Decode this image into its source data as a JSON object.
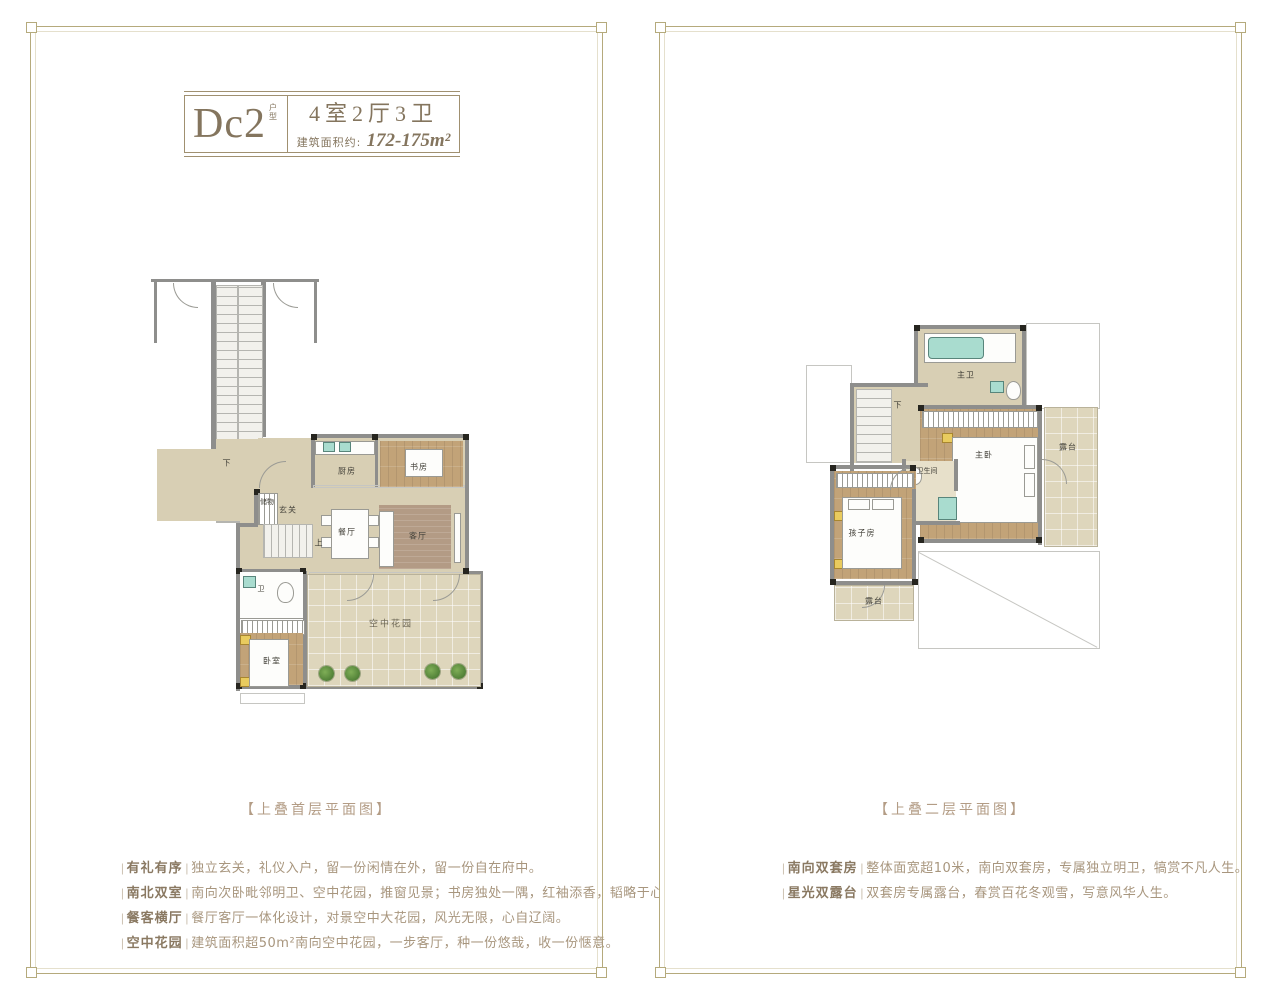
{
  "colors": {
    "frame": "#b5aa7c",
    "title_brown": "#84755e",
    "caption_brown": "#b39c85",
    "bullet_title": "#8a7962",
    "bullet_text": "#a8967e",
    "floor_tan": "#d8cfb4",
    "floor_wood": "#c2a378",
    "fixture_teal": "#a9dccf",
    "plant_green": "#4e7d35"
  },
  "bracket_open": "|",
  "bracket_close": "|",
  "left_panel": {
    "header": {
      "model": "Dc2",
      "model_tag": "户型",
      "layout": "4室2厅3卫",
      "area_label": "建筑面积约:",
      "area_value": "172-175m²"
    },
    "caption": "【上叠首层平面图】",
    "plan_labels": [
      "下",
      "厨房",
      "书房",
      "储物",
      "玄关",
      "餐厅",
      "客厅",
      "上",
      "卫",
      "卧室",
      "空中花园"
    ],
    "bullets": [
      {
        "title": "有礼有序",
        "text": "独立玄关，礼仪入户，留一份闲情在外，留一份自在府中。"
      },
      {
        "title": "南北双室",
        "text": "南向次卧毗邻明卫、空中花园，推窗见景；书房独处一隅，红袖添香，韬略于心。"
      },
      {
        "title": "餐客横厅",
        "text": "餐厅客厅一体化设计，对景空中大花园，风光无限，心自辽阔。"
      },
      {
        "title": "空中花园",
        "text": "建筑面积超50m²南向空中花园，一步客厅，种一份悠哉，收一份惬意。"
      }
    ]
  },
  "right_panel": {
    "caption": "【上叠二层平面图】",
    "plan_labels": [
      "主卫",
      "下",
      "主卧",
      "露台",
      "卫生间",
      "孩子房",
      "露台"
    ],
    "bullets": [
      {
        "title": "南向双套房",
        "text": "整体面宽超10米，南向双套房，专属独立明卫，犒赏不凡人生。"
      },
      {
        "title": "星光双露台",
        "text": "双套房专属露台，春赏百花冬观雪，写意风华人生。"
      }
    ]
  }
}
